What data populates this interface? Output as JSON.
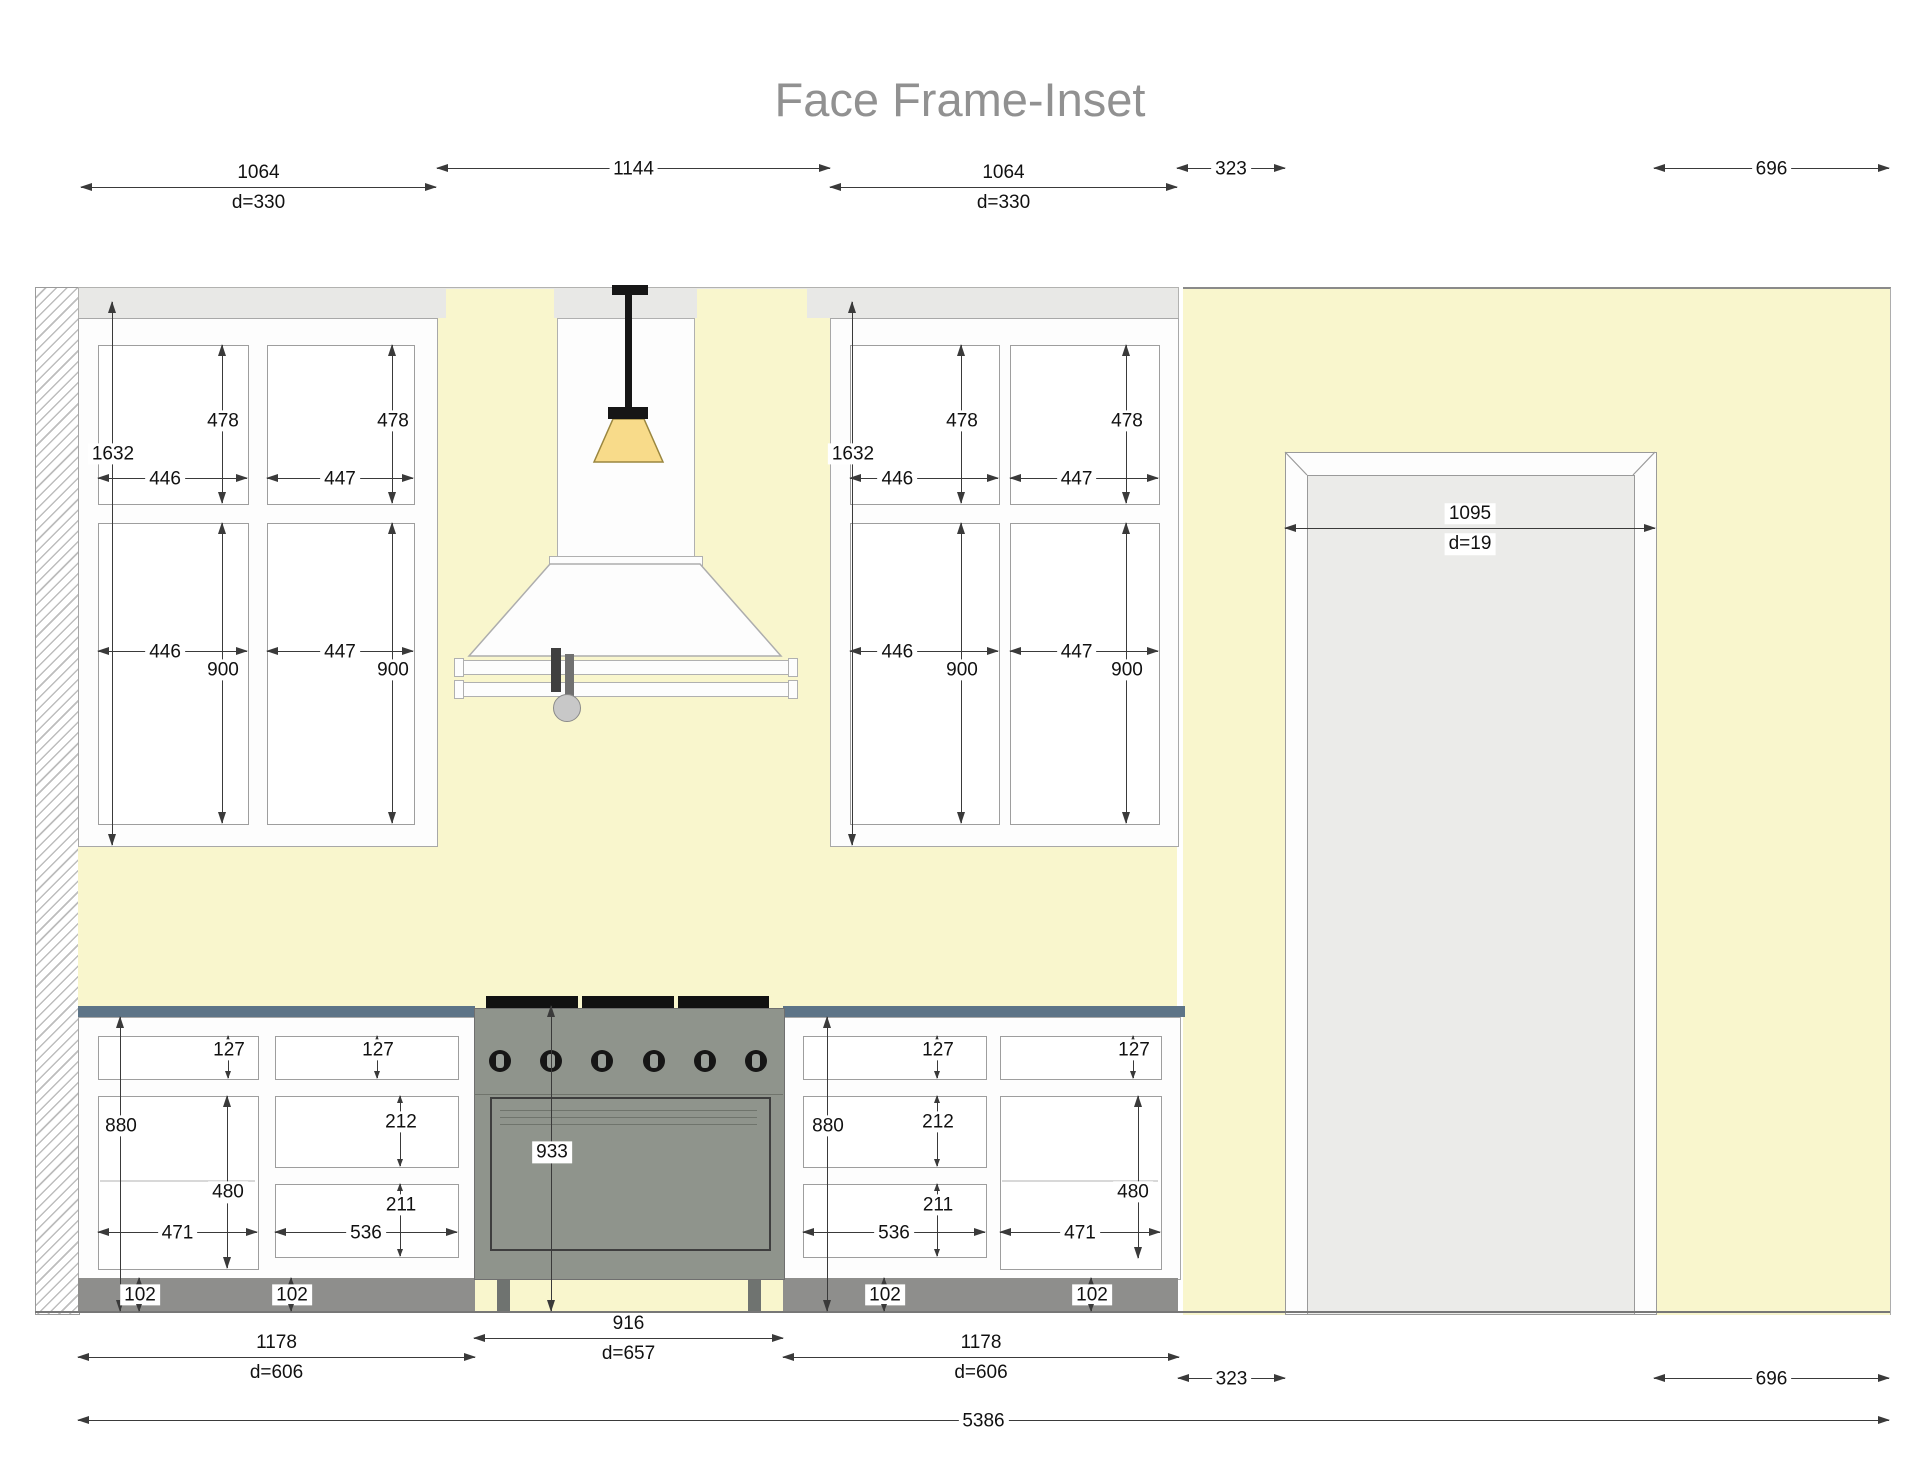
{
  "title": "Face Frame-Inset",
  "colors": {
    "wall": "#f9f6cd",
    "soffit": "#e8e8e6",
    "countertop": "#5d7487",
    "toe_kick": "#8e8e8c",
    "range_body": "#8f948c",
    "door_panel": "#ebebe9",
    "lamp_shade": "#f8db8a"
  },
  "dims": {
    "top": {
      "upper_left_w": "1064",
      "upper_left_d": "d=330",
      "hood_span": "1144",
      "upper_right_w": "1064",
      "upper_right_d": "d=330",
      "gap": "323",
      "wall_right": "696"
    },
    "upper_left": {
      "total_h": "1632",
      "door1_h": "478",
      "door2_h": "478",
      "door1_w": "446",
      "door2_w": "447",
      "lower1_h": "900",
      "lower2_h": "900",
      "lower1_w": "446",
      "lower2_w": "447"
    },
    "upper_right": {
      "total_h": "1632",
      "door1_h": "478",
      "door2_h": "478",
      "door1_w": "446",
      "door2_w": "447",
      "lower1_h": "900",
      "lower2_h": "900",
      "lower1_w": "446",
      "lower2_w": "447"
    },
    "doorway": {
      "w": "1095",
      "d": "d=19"
    },
    "base_left": {
      "run_h": "880",
      "drawer_h": "127",
      "door_h": "480",
      "door_w": "471",
      "bank_drawer1_h": "127",
      "bank_drawer2_h": "212",
      "bank_drawer3_h": "211",
      "bank_w": "536",
      "toe_kick_1": "102",
      "toe_kick_2": "102"
    },
    "base_right": {
      "run_h": "880",
      "drawer_h": "127",
      "door_h": "480",
      "door_w": "471",
      "bank_drawer1_h": "127",
      "bank_drawer2_h": "212",
      "bank_drawer3_h": "211",
      "bank_w": "536",
      "toe_kick_1": "102",
      "toe_kick_2": "102"
    },
    "range": {
      "counter_h": "933",
      "w": "916",
      "w_d": "d=657"
    },
    "bottom": {
      "left_run_w": "1178",
      "left_run_d": "d=606",
      "right_run_w": "1178",
      "right_run_d": "d=606",
      "gap": "323",
      "wall_right": "696",
      "total": "5386"
    }
  }
}
